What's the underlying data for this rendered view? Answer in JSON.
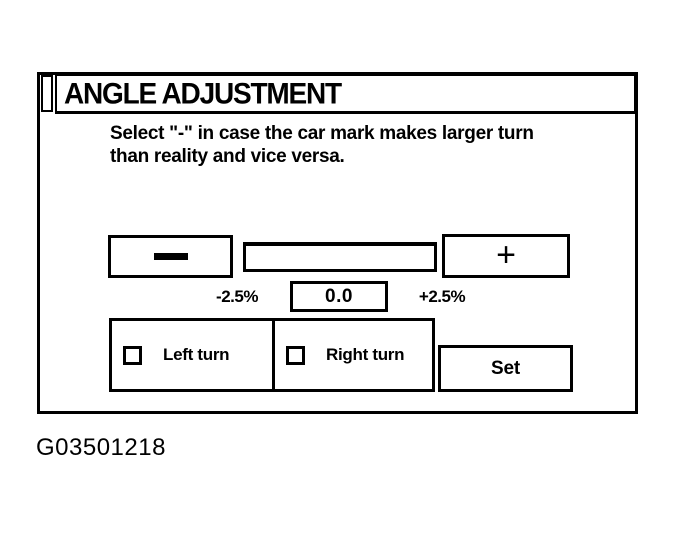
{
  "colors": {
    "ink": "#000000",
    "paper": "#ffffff"
  },
  "caption": "G03501218",
  "dialog": {
    "title": "ANGLE ADJUSTMENT",
    "instruction": {
      "line1": "Select \"-\" in case the car mark makes larger turn",
      "line2": "than reality and vice versa."
    },
    "adjust": {
      "minus_label": "−",
      "plus_label": "+",
      "min_label": "-2.5%",
      "value": "0.0",
      "max_label": "+2.5%"
    },
    "turn": {
      "left_label": "Left turn",
      "left_checked": false,
      "right_label": "Right turn",
      "right_checked": false
    },
    "set_label": "Set"
  }
}
